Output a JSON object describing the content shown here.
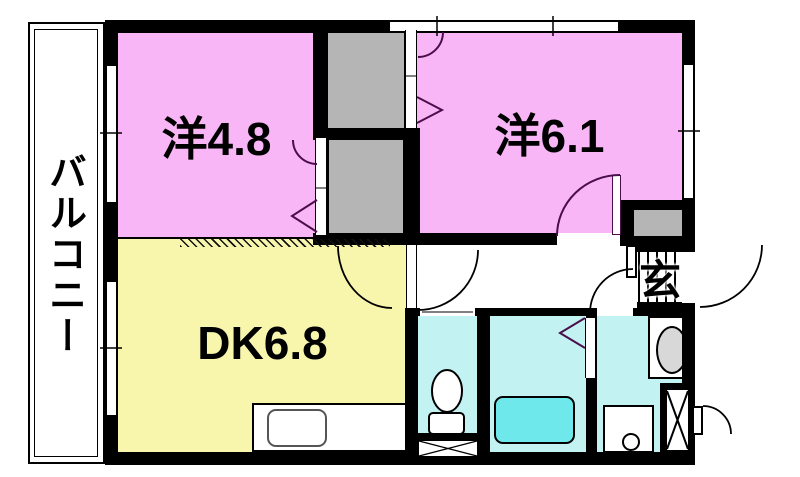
{
  "balcony": {
    "label": "バルコニー"
  },
  "rooms": {
    "western1": {
      "label": "洋4.8"
    },
    "western2": {
      "label": "洋6.1"
    },
    "dining_kitchen": {
      "label": "DK6.8"
    },
    "entrance": {
      "label": "玄"
    }
  },
  "colors": {
    "room_pink": "#f9b6f6",
    "dk_yellow": "#f8f5ad",
    "wet_cyan": "#c2f2f2",
    "tub_cyan": "#6fe8ec",
    "closet_gray": "#b5b5b5",
    "wall_black": "#000000",
    "door_purple": "#4a0e4a"
  }
}
